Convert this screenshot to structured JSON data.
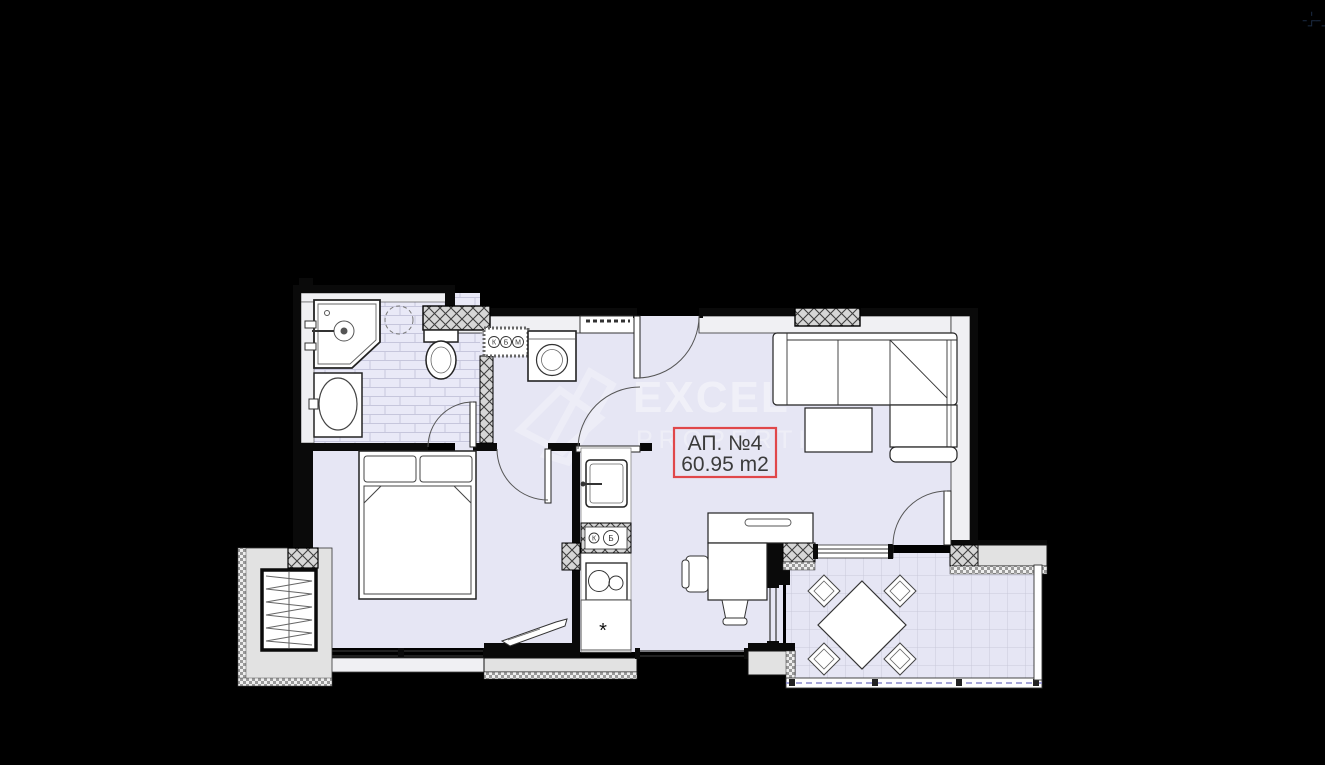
{
  "window": {
    "background": "#000000"
  },
  "icons": {
    "top_right_glyph": "✚✚",
    "top_right_name": "grid-icon"
  },
  "floorplan": {
    "label": {
      "title": "АП. №4",
      "area": "60.95 m2"
    },
    "watermark": {
      "line1": "EXCEL",
      "line2": "PROPERTIES"
    },
    "annotations": {
      "hall_meters": [
        "К",
        "Б",
        "М"
      ],
      "kitchen_meters": [
        "К",
        "Б"
      ],
      "kitchen_cabinet_mark": "*"
    },
    "colors": {
      "floor": "#e6e6f4",
      "tile_line": "#c6c6dc",
      "wall_band": "#f0f0f3",
      "wall_line": "#111111",
      "gray_block": "#e2e2e2",
      "label_border": "#e0474a",
      "label_text": "#3b3b3b",
      "railing_dash": "#8888cc",
      "watermark": "#ffffff"
    }
  }
}
